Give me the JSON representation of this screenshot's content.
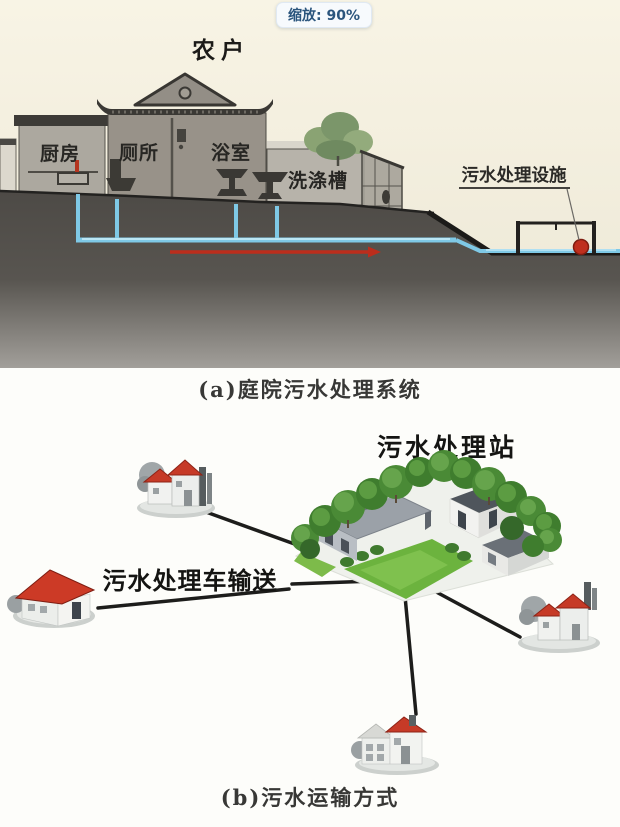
{
  "viewer": {
    "zoom_tooltip": "缩放: 90%"
  },
  "diagram_a": {
    "title": "农户",
    "rooms": [
      {
        "label": "厨房"
      },
      {
        "label": "厕所"
      },
      {
        "label": "浴室"
      },
      {
        "label": "洗涤槽"
      }
    ],
    "facility_label": "污水处理设施",
    "caption": "(a)庭院污水处理系统",
    "colors": {
      "background": "#f6f2e2",
      "ground": "#56534e",
      "pipe_blue": "#7fc9e6",
      "flow_arrow_red": "#bb2d1c",
      "outlet_dot_red": "#bf2f1e",
      "wall_gray": "#989289",
      "roof_dark": "#3b3935"
    }
  },
  "diagram_b": {
    "station_label": "污水处理站",
    "transport_label": "污水处理车输送",
    "caption": "(b)污水运输方式",
    "colors": {
      "roof_red": "#c63a27",
      "tree_green": "#4a8a36",
      "lawn_green": "#6cb33e",
      "route_line_black": "#1d1d1b",
      "base_gray": "#ccd0cd"
    }
  }
}
